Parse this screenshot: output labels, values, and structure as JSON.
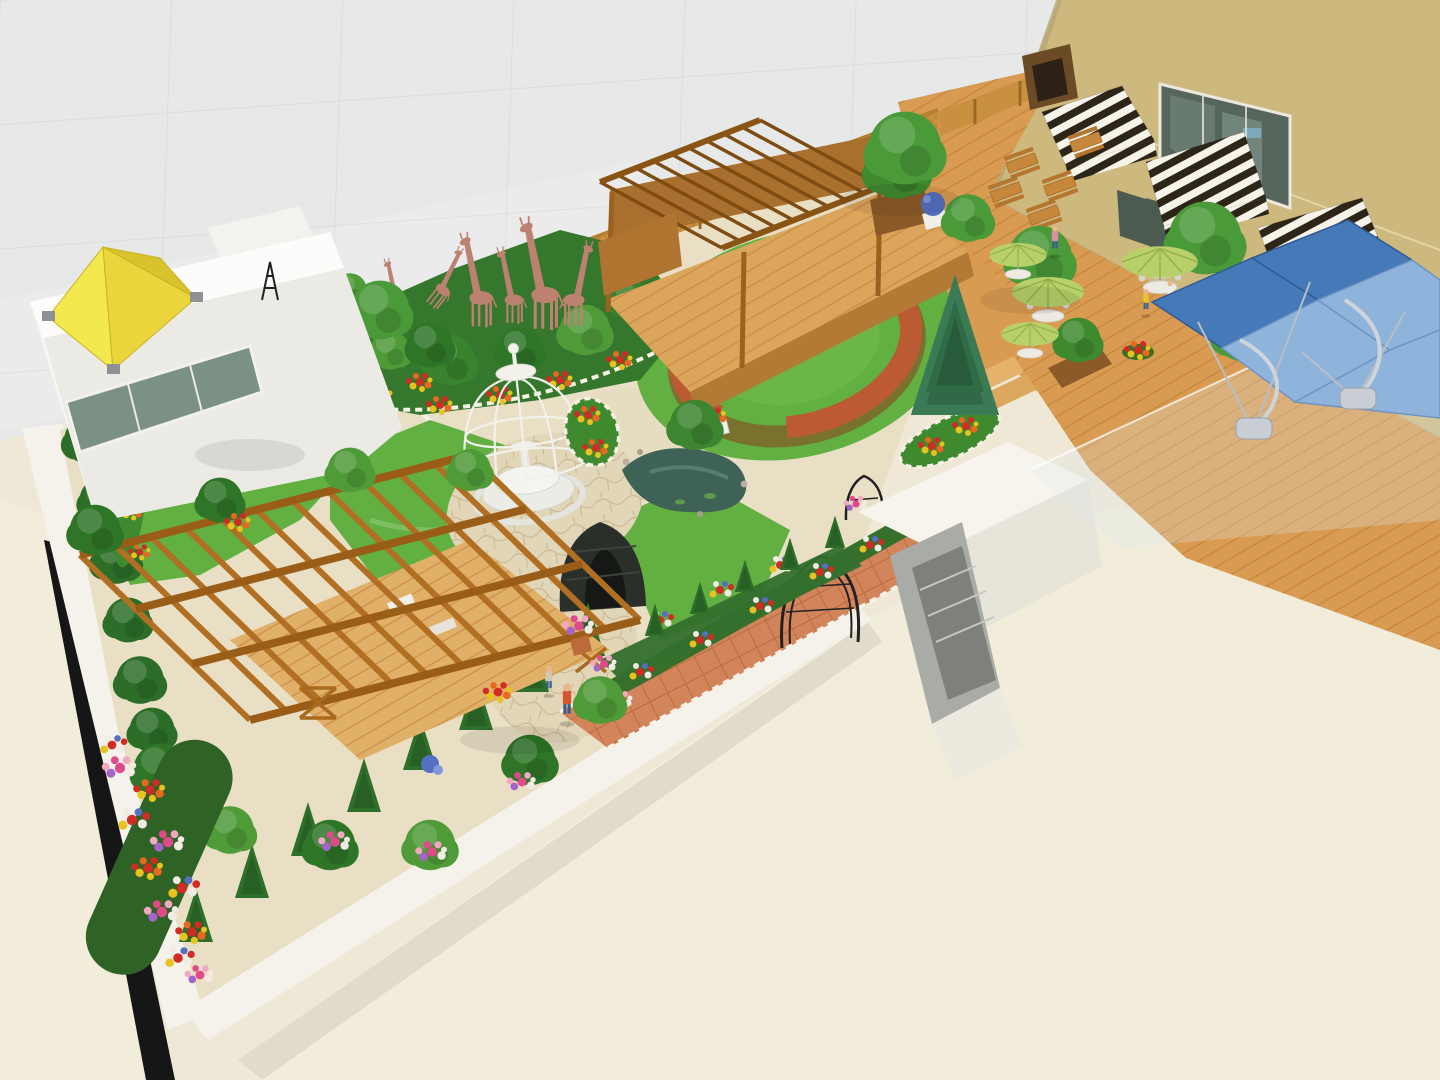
{
  "scene": {
    "title": "Rooftop garden – 3D architectural rendering (aerial isometric view)",
    "type": "3d-rendering",
    "setting": "landscaped rooftop terrace enclosed by a grey tiled tower wall and a beige wall",
    "counts": {
      "giraffe_sculptures": 6,
      "striped_awnings": 3,
      "green_parasols": 4,
      "blue_canopy_panels": 5,
      "picnic_tables": 5,
      "people": 7,
      "iron_arches": 3,
      "conifer_row_trees": 8
    },
    "elements": [
      "grey tiled facade wall",
      "beige wall with mirrored window, glass doors and striped awnings",
      "white rooftop cabin with yellow pyramid skylight and green glazing",
      "pink giraffe sculpture group in planting bed",
      "timber lattice fence",
      "timber pergola stage with wooden deck",
      "circular lawn with terracotta ring wall and white flower planters",
      "white wire birdcage gazebo with fountain",
      "garden pond with rocks",
      "winding cobble-edged cream paths with island flower bed",
      "flagstone terrace with strolling visitors",
      "terracotta tiled walk with wrought-iron rose arches and dark arbour tunnel",
      "large timber pergola over deck surrounded by flowering shrubs",
      "conifer hedge rows and mixed flower borders",
      "cascading flower pillar spilling over the parapet",
      "cafe deck with picnic tables, round tables and green parasols",
      "blue cantilevered shade canopies with curved masts and weighted bases",
      "glass balustrade",
      "white stairwell enclosure",
      "cream lower rooftop slabs with white parapets",
      "blue spruce tree",
      "blue hydrangea urn"
    ],
    "people": [
      "adult in orange shirt and jeans on flagstone path",
      "child beside adult on flagstone path",
      "person strolling on cafe deck",
      "children seated at parasol tables"
    ]
  },
  "colors": {
    "wall_gray": "#e7e9e8",
    "wall_gray_line": "#d4d8d7",
    "wall_tan": "#cdb97e",
    "wall_tan_line": "#e3d4a4",
    "window_glass": "#56665d",
    "roof_cream": "#f2ecdb",
    "parapet_white": "#f4f2ea",
    "shadow_black": "#161616",
    "paving_cream": "#e9dfc5",
    "flagstone": "#e2d6b8",
    "path_edge_white": "#f7f3e8",
    "tile_terracotta": "#d2845a",
    "deck_wood": "#d99b52",
    "stage_wood": "#dca55c",
    "pergola_wood": "#b06f22",
    "pergola_beam": "#8a5414",
    "fence_wood": "#c9913f",
    "lawn": "#61b041",
    "terracotta_ring": "#bb5a33",
    "foliage_dark": "#2e6f2a",
    "foliage_mid": "#3f8a2f",
    "foliage_light": "#4f9b38",
    "conifer": "#2e6f2a",
    "spruce": "#3a7a55",
    "giraffe_pink": "#bd8172",
    "cage_white": "#f2f1ec",
    "pond_water": "#3f6257",
    "skylight_yellow": "#f3e94e",
    "awning_dark": "#2e2519",
    "awning_light": "#f6f3ea",
    "canopy_dark_blue": "#4579b8",
    "canopy_light_blue": "#8fb4dc",
    "umbrella_green": "#b7d06a",
    "glass_tint": "#dfe9ee",
    "flower_red": "#cf2d24",
    "flower_yellow": "#e8c21f",
    "flower_pink": "#e0498a",
    "flower_white": "#f0ece4",
    "flower_blue": "#5570c0",
    "shirt_orange": "#d4552e"
  }
}
